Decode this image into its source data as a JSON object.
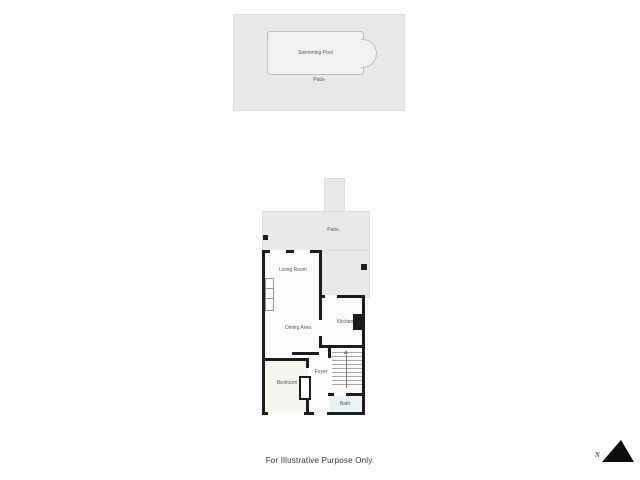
{
  "pool_area": {
    "pool_label": "Swimming Pool",
    "patio_label": "Patio"
  },
  "floorplan": {
    "rooms": {
      "patio": "Patio",
      "living_room": "Living Room",
      "dining_area": "Dining Area",
      "kitchen": "Kitchen",
      "foyer": "Foyer",
      "bedroom": "Bedroom",
      "bath": "Bath"
    }
  },
  "footer": {
    "disclaimer": "For Illustrative Purpose Only."
  },
  "compass": {
    "letter": "N"
  },
  "colors": {
    "background": "#ffffff",
    "patio_fill": "#e9e9e9",
    "pool_fill": "#f2f2f2",
    "pool_border": "#bdbdbd",
    "wall": "#1c1c1c",
    "room_fill": "#fcfcfc",
    "bedroom_fill": "#f3f6ee",
    "bath_fill": "#e9f3f7",
    "label_color": "#555555"
  }
}
